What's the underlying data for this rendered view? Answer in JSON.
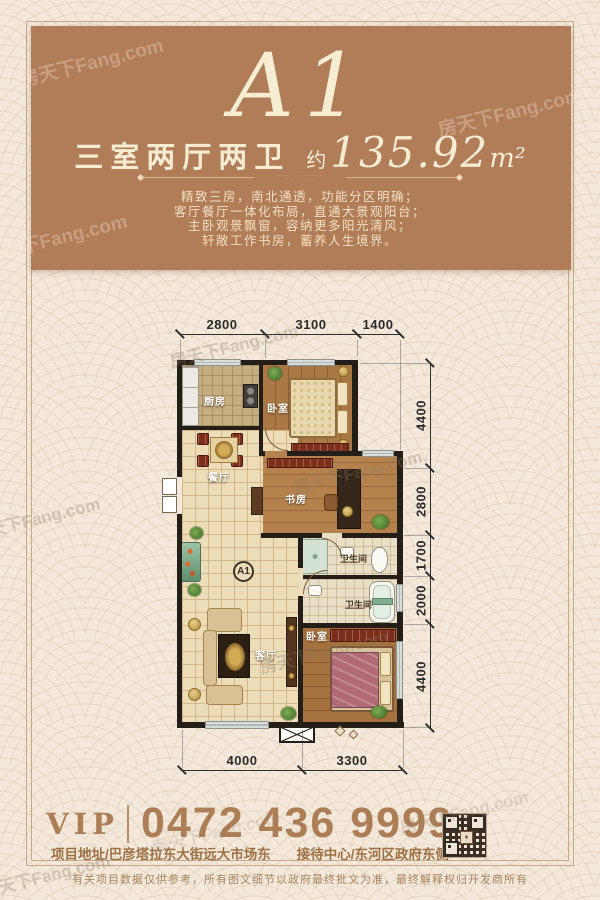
{
  "watermark": {
    "text": "房天下Fang.com"
  },
  "header": {
    "title": "A1",
    "layout_label": "三室两厅两卫",
    "approx_label": "约",
    "area_value": "135.92",
    "area_unit": "m²",
    "divider_dots_1": "·····················",
    "divider_dots_2": "·············",
    "description_lines": [
      "精致三房，南北通透，功能分区明确；",
      "客厅餐厅一体化布局，直通大景观阳台；",
      "主卧观景飘窗，容纳更多阳光清风；",
      "轩敞工作书房，蓄养人生境界。"
    ]
  },
  "floorplan": {
    "badge": "A1",
    "rooms": {
      "kitchen": "厨房",
      "bedroom1": "卧室",
      "dining": "餐厅",
      "study": "书房",
      "bath1": "卫生间",
      "bath2": "卫生间",
      "living": "客厅",
      "bedroom2": "卧室"
    },
    "dims_top": [
      "2800",
      "3100",
      "1400"
    ],
    "dims_right": [
      "4400",
      "2800",
      "1700",
      "2000",
      "4400"
    ],
    "dims_bottom": [
      "4000",
      "3300"
    ]
  },
  "footer": {
    "vip_label": "VIP",
    "phone": "0472 436 9999",
    "address": "项目地址/巴彦塔拉东大街远大市场东",
    "reception": "接待中心/东河区政府东侧",
    "disclaimer": "有关项目数据仅供参考，所有图文细节以政府最终批文为准，最终解释权归开发商所有"
  }
}
